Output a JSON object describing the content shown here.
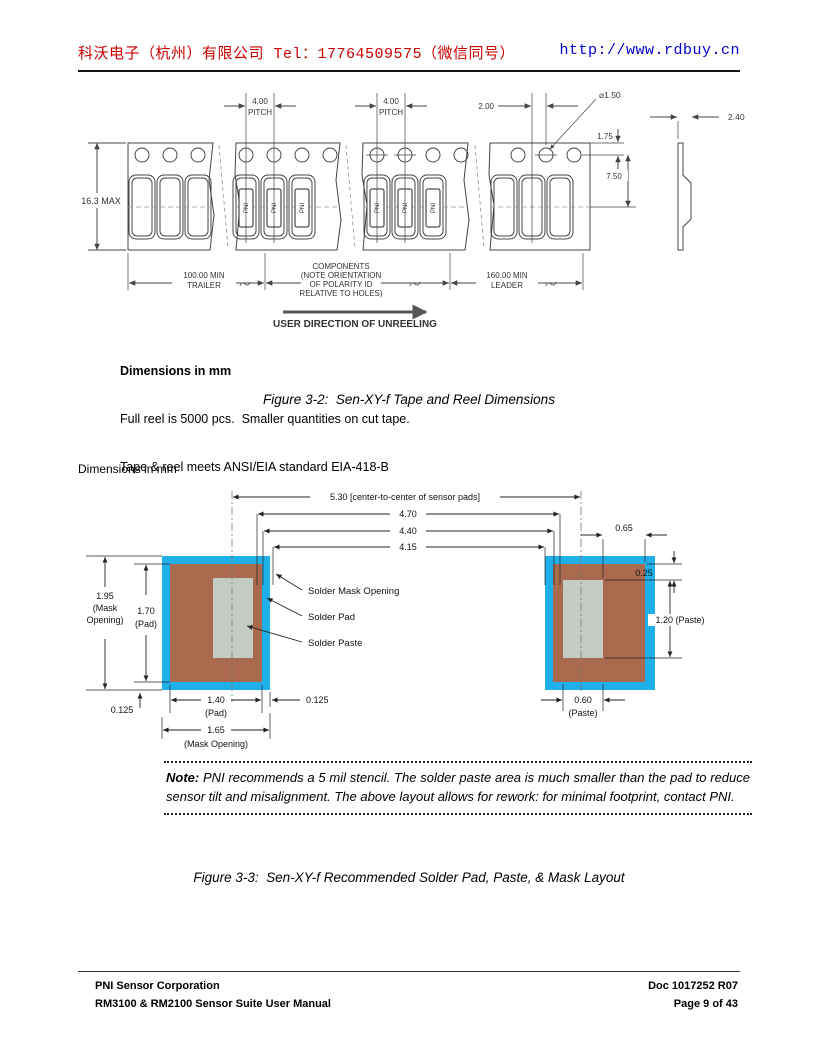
{
  "header": {
    "company": "科沃电子（杭州）有限公司 Tel：17764509575（微信同号）",
    "company_color": "#cc0000",
    "website": "http://www.rdbuy.cn",
    "website_color": "#0000cc"
  },
  "tape_figure": {
    "marking": "PNI",
    "dim_height": "16.3 MAX",
    "dim_pitch_value": "4.00",
    "dim_pitch_label": "PITCH",
    "dim_hole_offset": "2.00",
    "dim_hole_dia": "⌀1.50",
    "dim_hole_top": "1.75",
    "dim_hole_center": "7.50",
    "dim_thickness": "2.40",
    "trailer_line1": "100.00 MIN",
    "trailer_line2": "TRAILER",
    "components_line1": "COMPONENTS",
    "components_line2": "(NOTE ORIENTATION",
    "components_line3": "OF POLARITY ID",
    "components_line4": "RELATIVE TO  HOLES)",
    "leader_line1": "160.00 MIN",
    "leader_line2": "LEADER",
    "unreeling_label": "USER DIRECTION OF UNREELING",
    "notes_title": "Dimensions in mm",
    "notes_line1": "Full reel is 5000 pcs.  Smaller quantities on cut tape.",
    "notes_line2": "Tape & reel meets ANSI/EIA standard EIA-418-B",
    "caption": "Figure 3-2:  Sen-XY-f Tape and Reel Dimensions"
  },
  "pad_figure": {
    "units_label": "Dimensions in mm",
    "colors": {
      "mask": "#1fb0ea",
      "pad": "#a96a4e",
      "paste": "#c3cbc3"
    },
    "dim_center_to_center": "5.30 [center-to-center of sensor pads]",
    "dim_470": "4.70",
    "dim_440": "4.40",
    "dim_415": "4.15",
    "dim_065": "0.65",
    "dim_025": "0.25",
    "dim_120": "1.20  (Paste)",
    "dim_195_line1": "1.95",
    "dim_195_line2": "(Mask",
    "dim_195_line3": "Opening)",
    "dim_170_line1": "1.70",
    "dim_170_line2": "(Pad)",
    "dim_0125_left": "0.125",
    "dim_140_line1": "1.40",
    "dim_140_line2": "(Pad)",
    "dim_0125_right": "0.125",
    "dim_165_line1": "1.65",
    "dim_165_line2": "(Mask Opening)",
    "dim_060_line1": "0.60",
    "dim_060_line2": "(Paste)",
    "label_mask": "Solder Mask Opening",
    "label_pad": "Solder Pad",
    "label_paste": "Solder Paste",
    "caption": "Figure 3-3:  Sen-XY-f Recommended Solder Pad, Paste, & Mask Layout"
  },
  "note": {
    "label": "Note:",
    "body": "PNI recommends a 5 mil stencil.  The solder paste area is much smaller than the pad to reduce sensor tilt and misalignment.  The above layout allows for rework:  for minimal footprint, contact PNI."
  },
  "footer": {
    "company": "PNI Sensor Corporation",
    "manual": "RM3100 & RM2100 Sensor Suite User Manual",
    "doc": "Doc 1017252 R07",
    "page": "Page 9 of 43"
  }
}
